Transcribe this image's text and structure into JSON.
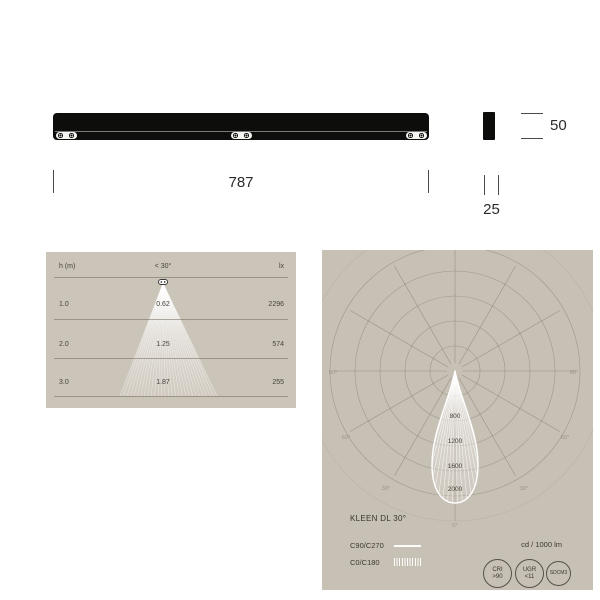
{
  "meta": {
    "background": "#ffffff",
    "panel_bg_left": "#cbc4b9",
    "panel_bg_right": "#c7c0b5",
    "drawing_color": "#0d0d0c",
    "text_color": "#3c382f",
    "beam_color": "#ffffff"
  },
  "dimension_drawing": {
    "length_label": "787",
    "height_label": "50",
    "width_label": "25"
  },
  "cone_panel": {
    "header": {
      "h": "h (m)",
      "angle": "< 30°",
      "lx": "lx"
    },
    "rows": [
      {
        "h": "1.0",
        "d": "0.62",
        "lx": "2296"
      },
      {
        "h": "2.0",
        "d": "1.25",
        "lx": "574"
      },
      {
        "h": "3.0",
        "d": "1.87",
        "lx": "255"
      }
    ]
  },
  "polar_panel": {
    "title": "KLEEN DL 30°",
    "legend": [
      {
        "label": "C90/C270",
        "style": "solid"
      },
      {
        "label": "C0/C180",
        "style": "hatched"
      }
    ],
    "unit": "cd / 1000 lm",
    "ring_labels": [
      "800",
      "1200",
      "1600",
      "2000"
    ],
    "angle_labels": {
      "deg90": "90°",
      "deg60": "60°",
      "deg30": "30°",
      "deg0": "0°"
    },
    "badges": [
      {
        "line1": "CRI",
        "line2": ">90"
      },
      {
        "line1": "UGR",
        "line2": "<11"
      },
      {
        "line1": "SDCM3",
        "line2": ""
      }
    ]
  },
  "chart_data": [
    {
      "type": "line",
      "subtype": "polar-photometric",
      "title": "KLEEN DL 30°",
      "series": [
        {
          "name": "C90/C270",
          "style": "solid-outline"
        },
        {
          "name": "C0/C180",
          "style": "hatched"
        }
      ],
      "ring_values_cd": [
        400,
        800,
        1200,
        1600,
        2000
      ],
      "ring_labels_shown": [
        "800",
        "1200",
        "1600",
        "2000"
      ],
      "max_intensity_cd_per_1000lm": 2100,
      "beam_angle_deg": 30,
      "unit": "cd / 1000 lm",
      "angle_ticks_deg": [
        0,
        30,
        60,
        90
      ]
    },
    {
      "type": "table",
      "title": "Illuminance cone",
      "columns": [
        "h (m)",
        "< 30°",
        "lx"
      ],
      "rows": [
        [
          1.0,
          0.62,
          2296
        ],
        [
          2.0,
          1.25,
          574
        ],
        [
          3.0,
          1.87,
          255
        ]
      ]
    }
  ]
}
